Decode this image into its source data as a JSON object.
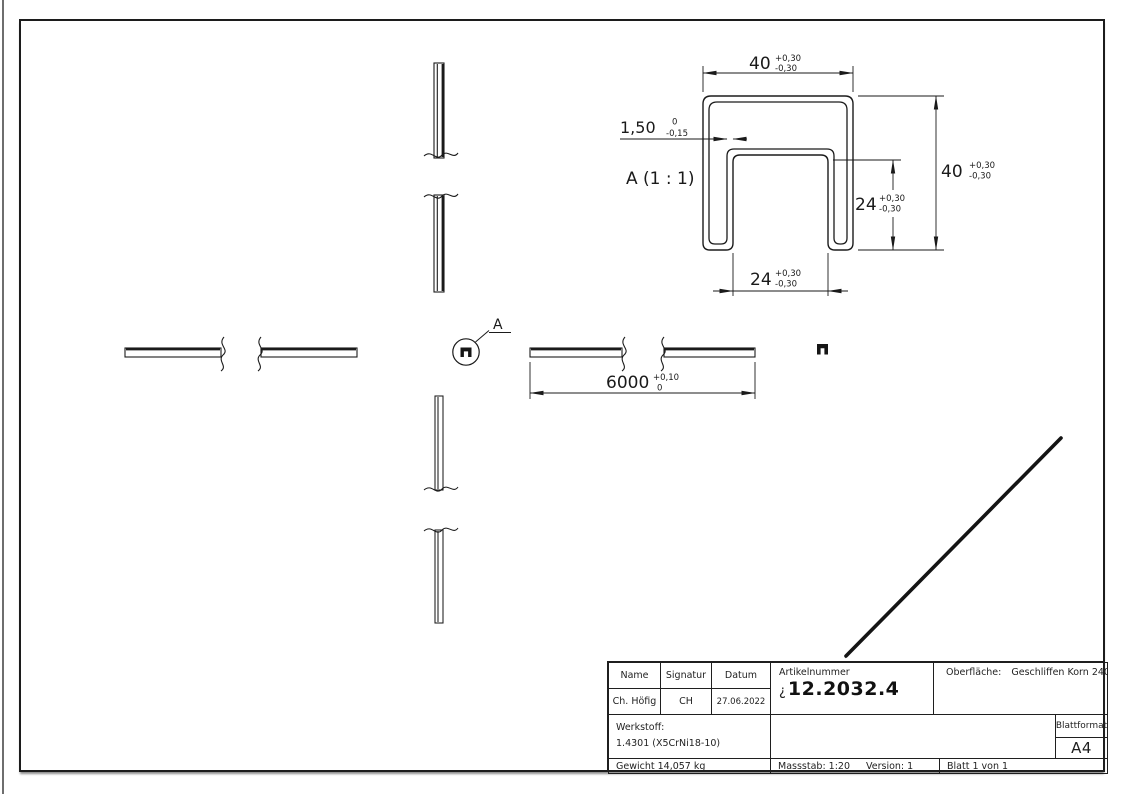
{
  "detail_view": {
    "title": "A (1 : 1)",
    "callout_label": "A",
    "dims": {
      "width": {
        "v": "40",
        "p": "+0,30",
        "m": "-0,30"
      },
      "thickness": {
        "v": "1,50",
        "p": "0",
        "m": "-0,15"
      },
      "height": {
        "v": "40",
        "p": "+0,30",
        "m": "-0,30"
      },
      "inner_height": {
        "v": "24",
        "p": "+0,30",
        "m": "-0,30"
      },
      "inner_width": {
        "v": "24",
        "p": "+0,30",
        "m": "-0,30"
      }
    }
  },
  "length_dim": {
    "v": "6000",
    "p": "+0,10",
    "m": "0"
  },
  "title_block": {
    "name_label": "Name",
    "signatur_label": "Signatur",
    "datum_label": "Datum",
    "name": "Ch. Höfig",
    "signatur": "CH",
    "datum": "27.06.2022",
    "artikelnummer_label": "Artikelnummer",
    "artikelnummer_prefix": "¿",
    "artikelnummer": "12.2032.4",
    "oberflaeche_label": "Oberfläche:",
    "oberflaeche_value": "Geschliffen Korn 240",
    "werkstoff_label": "Werkstoff:",
    "werkstoff_value": "1.4301 (X5CrNi18-10)",
    "gewicht": "Gewicht 14,057 kg",
    "massstab": "Massstab: 1:20",
    "version": "Version: 1",
    "blatt": "Blatt 1 von 1",
    "blattformat_label": "Blattformat",
    "blattformat_value": "A4"
  }
}
